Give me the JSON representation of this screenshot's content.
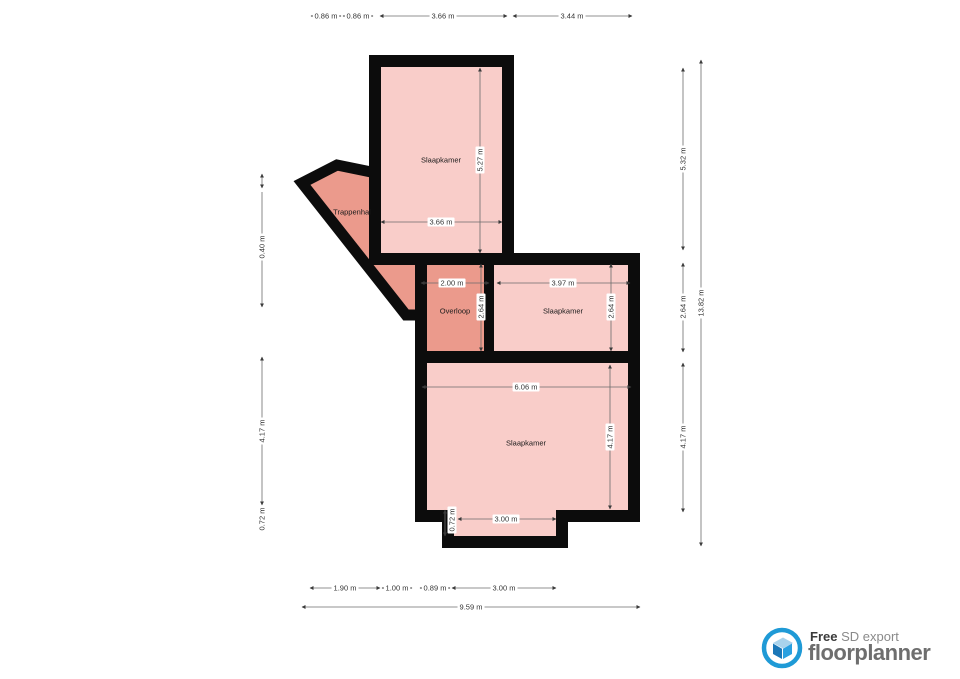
{
  "app": {
    "type": "floorplan-export"
  },
  "rooms": {
    "slaapkamer_top": {
      "label": "Slaapkamer",
      "width_label": "3.66 m",
      "height_label": "5.27 m"
    },
    "trappenhal": {
      "label": "Trappenhal"
    },
    "overloop": {
      "label": "Overloop",
      "width_label": "2.00 m",
      "height_label": "2.64 m"
    },
    "slaapkamer_mid": {
      "label": "Slaapkamer",
      "width_label": "3.97 m",
      "height_label": "2.64 m"
    },
    "slaapkamer_bottom": {
      "label": "Slaapkamer",
      "width_label": "6.06 m",
      "height_label": "4.17 m",
      "notch_width_label": "3.00 m",
      "notch_height_label": "0.72 m"
    }
  },
  "dimensions": {
    "top": [
      "0.86 m",
      "0.86 m",
      "3.66 m",
      "3.44 m"
    ],
    "left": [
      "0.40 m",
      "4.17 m",
      "0.72 m"
    ],
    "right": [
      "5.32 m",
      "2.64 m",
      "4.17 m"
    ],
    "right_total": "13.82 m",
    "bottom": [
      "1.90 m",
      "1.00 m",
      "0.89 m",
      "3.00 m"
    ],
    "bottom_total": "9.59 m"
  },
  "branding": {
    "free": "Free",
    "export_type": "SD export",
    "brand": "floorplanner"
  },
  "colors": {
    "wall": "#0c0c0c",
    "room_light": "#f9cdc9",
    "room_accent": "#eb9a8c",
    "dimension_line": "#6b6b6b",
    "dimension_text": "#333333",
    "logo_blue": "#1f9ad6",
    "logo_house_light": "#a9d3ec",
    "logo_house_dark": "#1a77b8",
    "logo_house_mid": "#2aa0e0",
    "logo_text_dark": "#3a3a3a",
    "logo_text_gray": "#8a8a8a",
    "brand_text": "#6e6e6e"
  }
}
